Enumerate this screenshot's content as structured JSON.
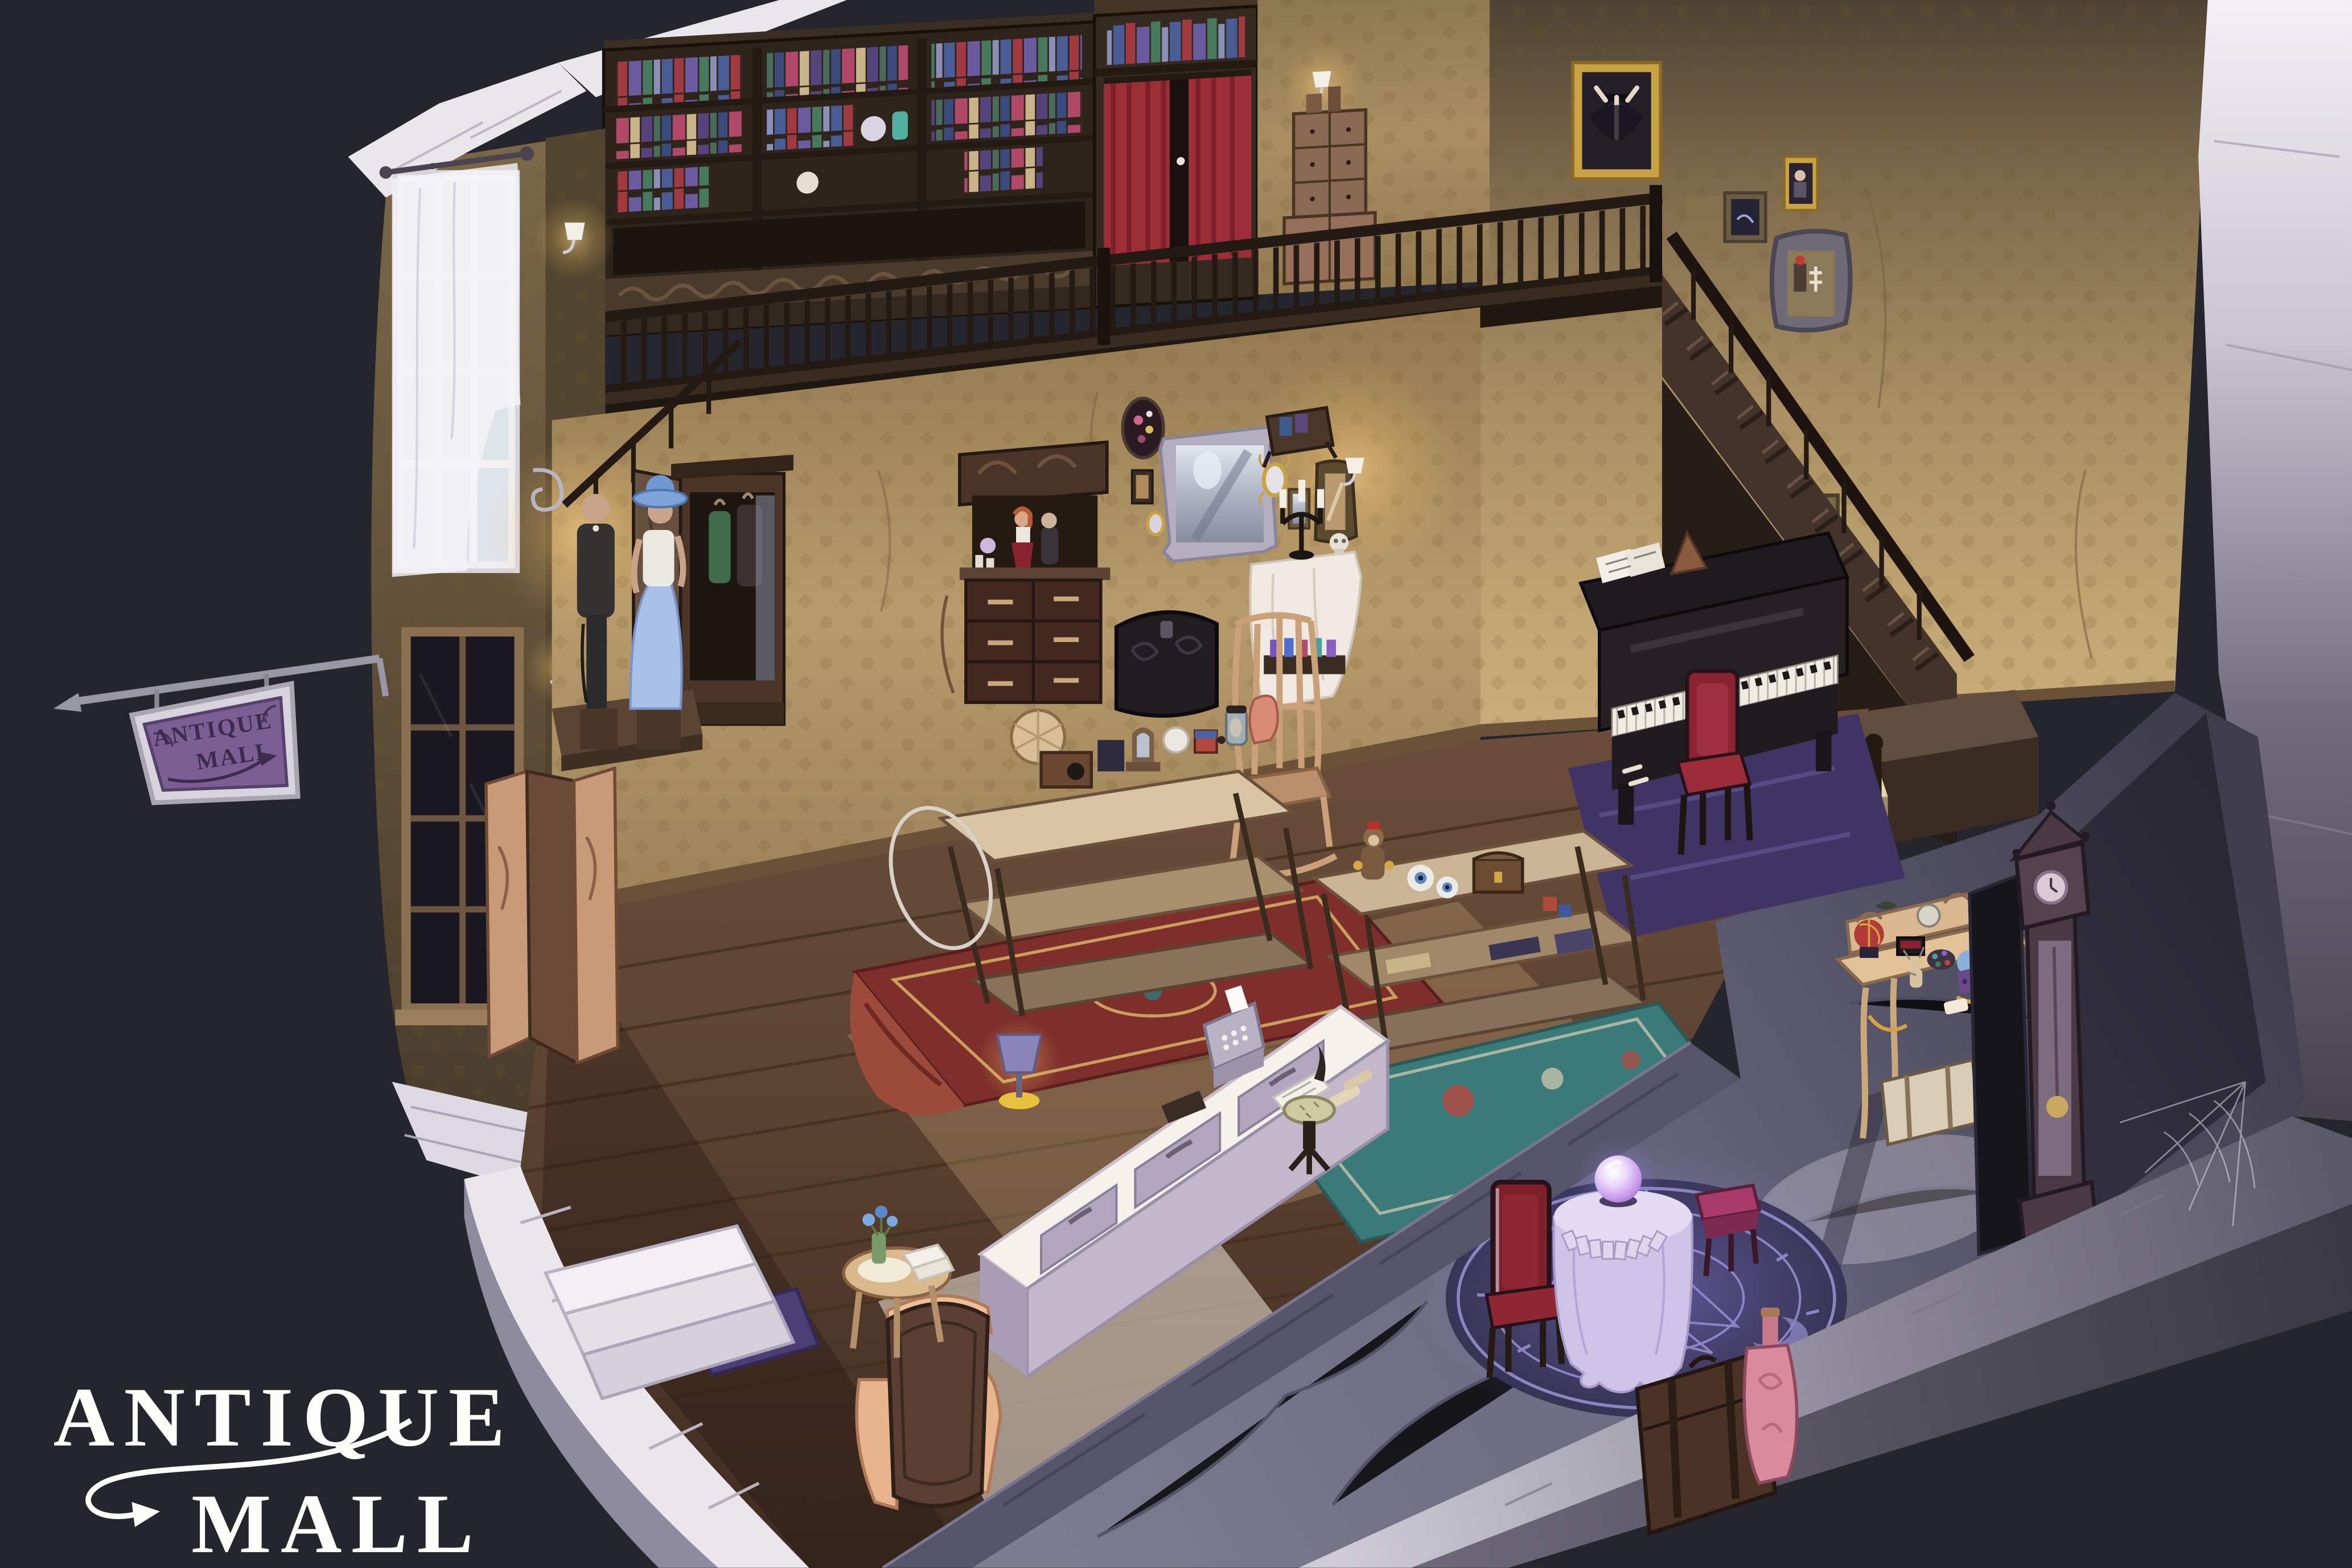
{
  "logo": {
    "line1": "ANTIQUE",
    "line2": "MALL"
  },
  "hanging_sign": {
    "line1": "ANTIQUE",
    "line2": "MALL"
  },
  "palette": {
    "background": "#25252d",
    "stone_light": "#e9e7ec",
    "stone_shadow": "#565468",
    "wallpaper_tan": "#b89d6e",
    "wood_dark": "#33281f",
    "wood_floor": "#5e4534",
    "curtain_red": "#9c2e38",
    "sign_purple": "#7b5f93",
    "magic_glow": "#8d7fe0",
    "lamp_glow": "#ffd27a",
    "crystal_ball": "#c79aec"
  }
}
